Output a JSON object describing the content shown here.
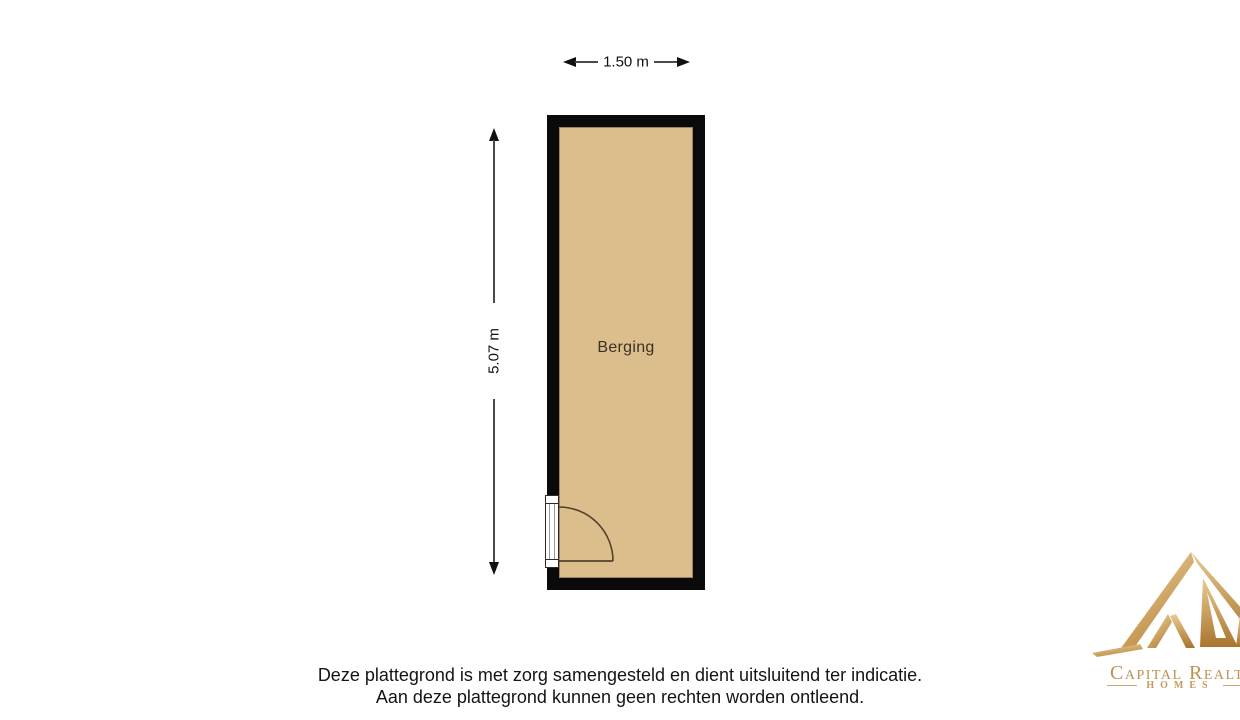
{
  "plan": {
    "room": {
      "label": "Berging"
    },
    "dimensions": {
      "width_label": "1.50 m",
      "height_label": "5.07 m"
    },
    "colors": {
      "wall": "#0a0a0a",
      "floor": "#dcbd8c",
      "door_line": "#55422c",
      "dimension_line": "#4a4a4a"
    }
  },
  "disclaimer": {
    "line1": "Deze plattegrond is met zorg samengesteld en dient uitsluitend ter indicatie.",
    "line2": "Aan deze plattegrond kunnen geen rechten worden ontleend."
  },
  "logo": {
    "brand": "Capital Realties",
    "tagline": "HOMES",
    "colors": {
      "gold_light": "#efd9a8",
      "gold_dark": "#b9853b",
      "text_gold": "#be9150"
    }
  }
}
